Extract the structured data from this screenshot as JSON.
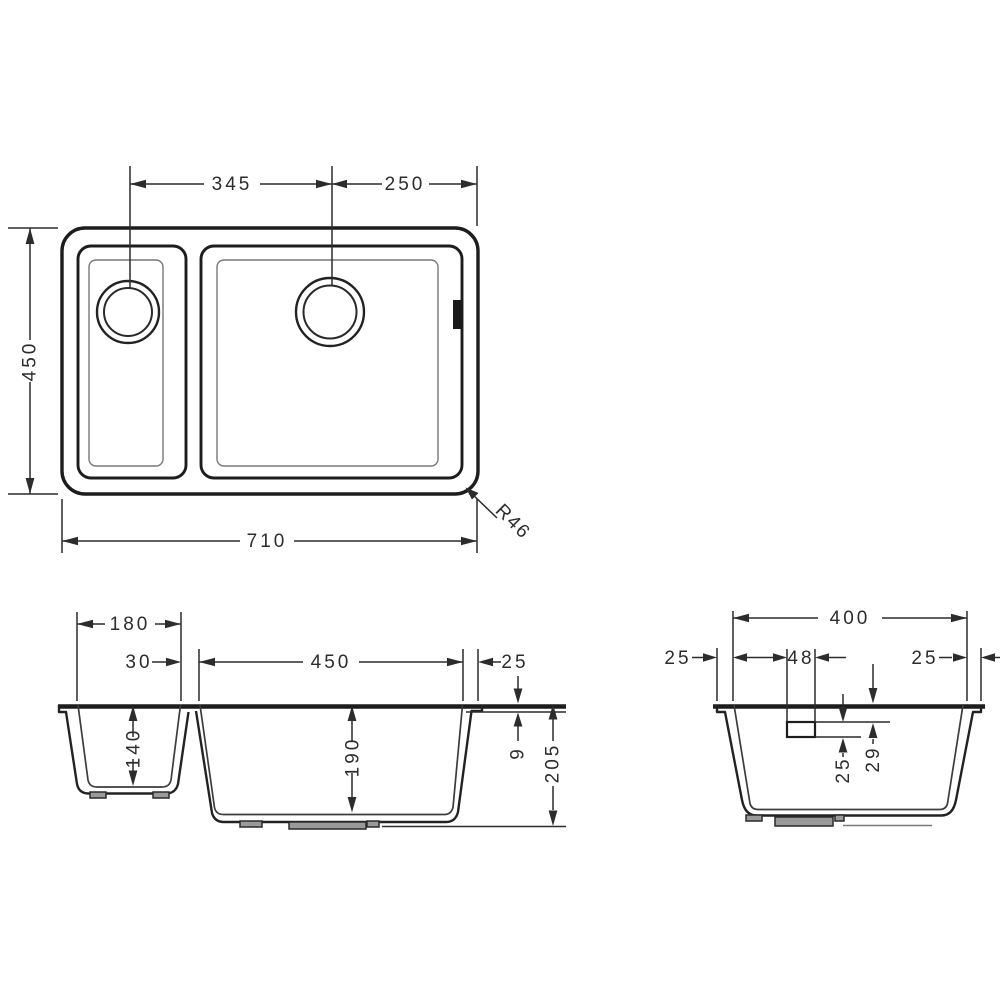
{
  "drawing": {
    "background": "#ffffff",
    "line_color": "#1d1d1d",
    "dim_color": "#2c2c2c",
    "views": {
      "plan": {
        "dims": {
          "drain_spacing": "345",
          "drain_to_right_edge": "250",
          "overall_depth": "450",
          "overall_width": "710",
          "corner_radius": "R46"
        }
      },
      "front": {
        "dims": {
          "small_bowl_width": "180",
          "divider_width": "30",
          "main_bowl_width": "450",
          "rim_overhang": "25",
          "small_bowl_depth": "140",
          "main_bowl_depth": "190",
          "rim_thickness": "9",
          "overall_height": "205"
        }
      },
      "side": {
        "dims": {
          "bowl_length": "400",
          "front_margin": "25",
          "overflow_width": "48",
          "back_margin": "25",
          "rim_to_overflow": "29",
          "overflow_height": "25"
        }
      }
    }
  }
}
